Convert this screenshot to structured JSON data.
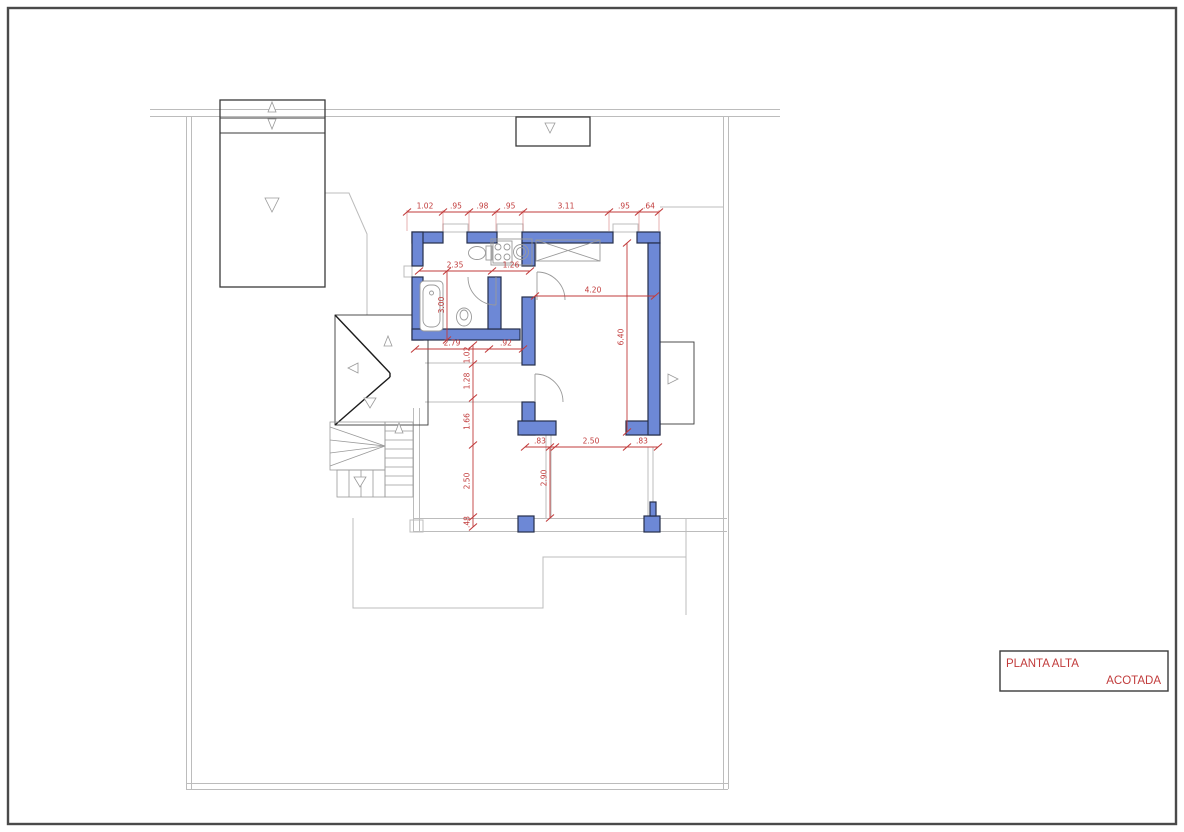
{
  "sheet": {
    "title_block": {
      "project": "PLANTA ALTA",
      "subtitle": "ACOTADA"
    }
  },
  "colors": {
    "wall_fill": "#6d88d6",
    "wall_stroke": "#252e4a",
    "dimension_red": "#c13b3b",
    "outline_gray": "#bcbcbc",
    "dark_line": "#3a3a3a"
  },
  "dims": {
    "top_chain": [
      "1.02",
      ".95",
      ".98",
      ".95",
      "3.11",
      ".95",
      ".64"
    ],
    "bath_width": "2.35",
    "kitchen_width": "1.26",
    "room_width": "4.20",
    "bath_height": "3.00",
    "room_height": "6.40",
    "hall_width": "2.79",
    "door_width": ".92",
    "left_chain": [
      "1.02",
      "1.28",
      "1.66",
      "2.50",
      ".48"
    ],
    "bottom_chain": [
      ".83",
      "2.50",
      ".83"
    ],
    "terrace_depth": "2.90"
  }
}
